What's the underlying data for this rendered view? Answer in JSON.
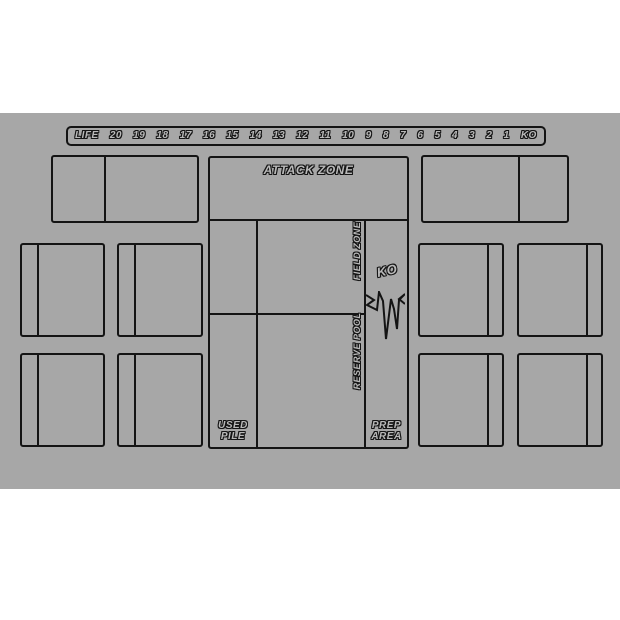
{
  "mat": {
    "background_color": "#a7a7a7",
    "line_color": "#141414",
    "text_fill_color": "#b9b9b9"
  },
  "life_track": {
    "label": "LIFE",
    "values": [
      "20",
      "19",
      "18",
      "17",
      "16",
      "15",
      "14",
      "13",
      "12",
      "11",
      "10",
      "9",
      "8",
      "7",
      "6",
      "5",
      "4",
      "3",
      "2",
      "1",
      "KO"
    ]
  },
  "zones": {
    "attack_zone_label": "ATTACK ZONE",
    "field_zone_label": "FIELD ZONE",
    "reserve_pool_label": "RESERVE POOL",
    "ko_label": "KO",
    "used_pile_line1": "USED",
    "used_pile_line2": "PILE",
    "prep_area_line1": "PREP",
    "prep_area_line2": "AREA"
  }
}
